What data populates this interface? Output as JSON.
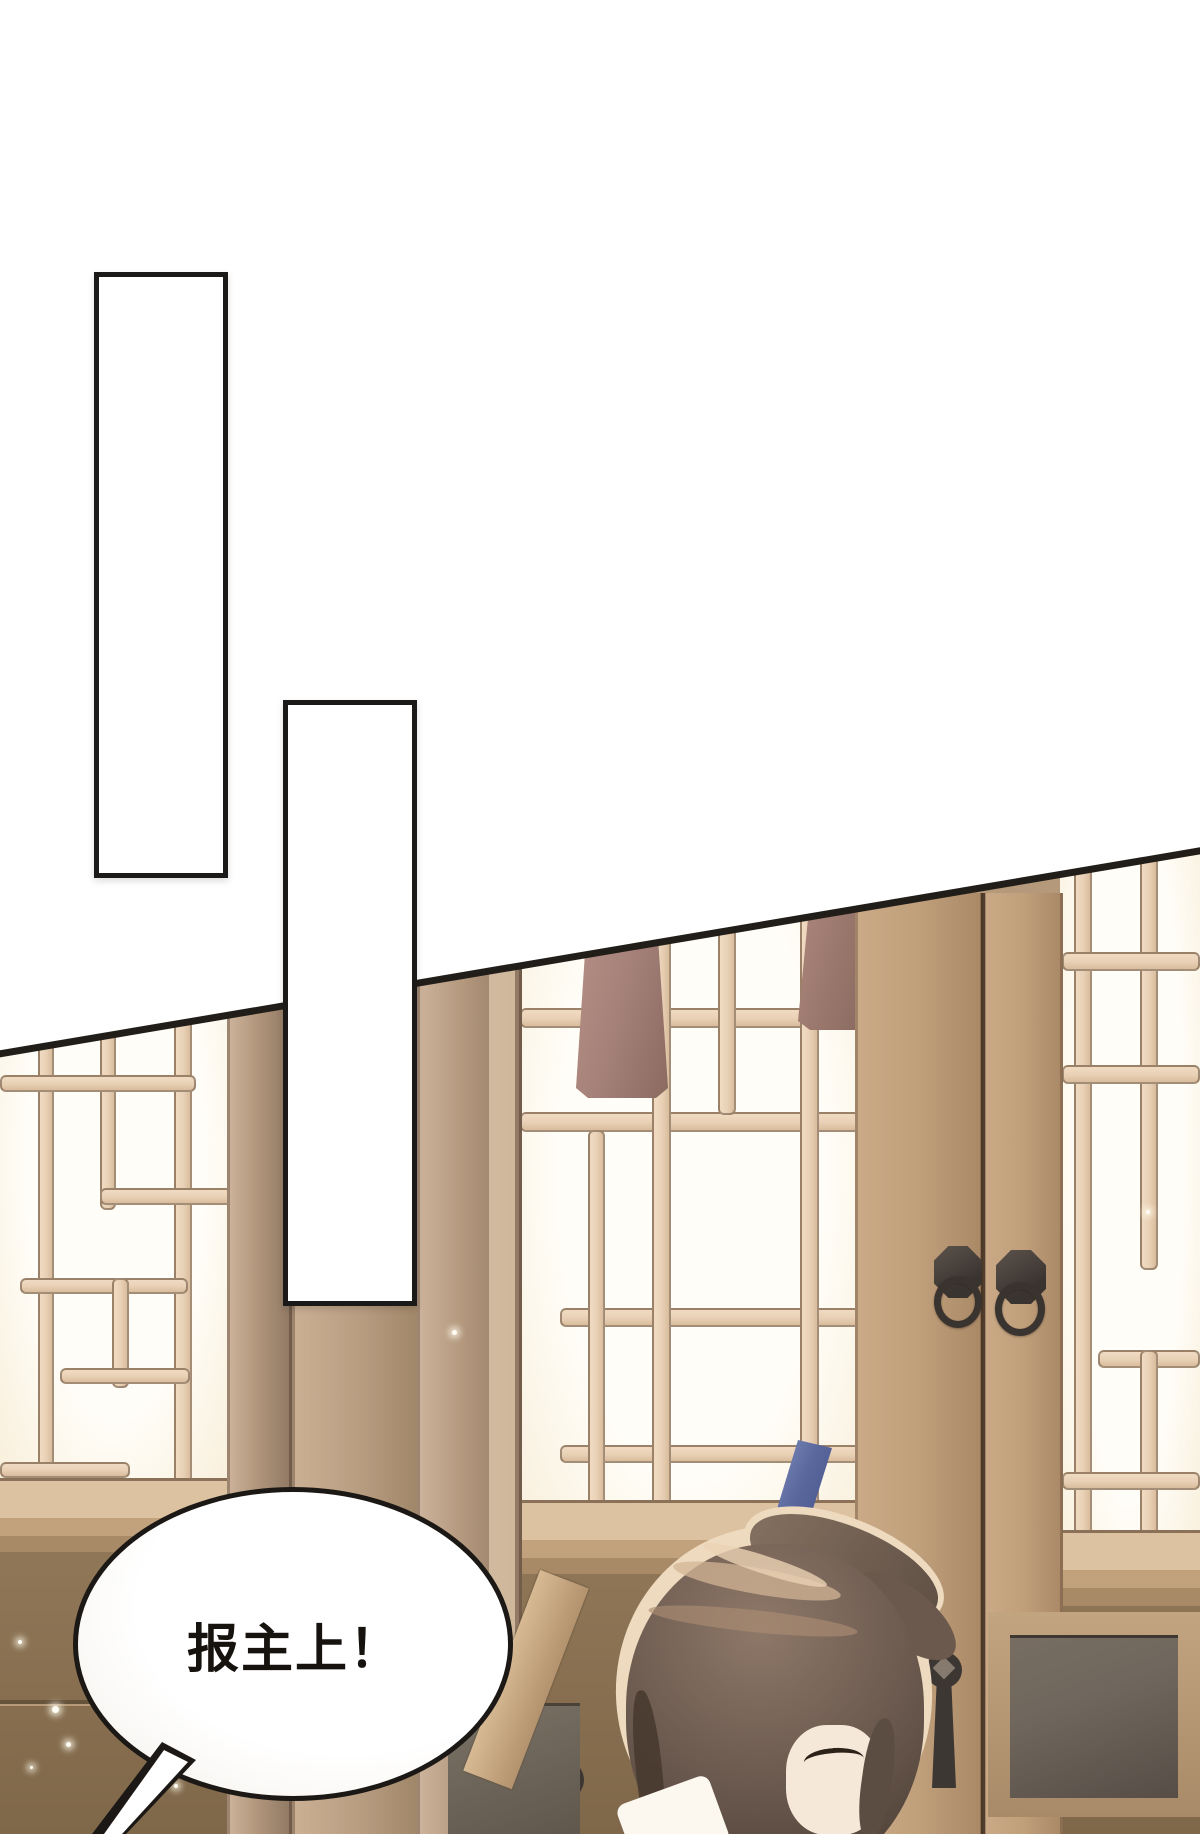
{
  "page": {
    "background_color": "#ffffff",
    "panel_border_color": "#1c1a18",
    "panel_count": 2
  },
  "speech_bubble": {
    "text": "报主上！",
    "fill_color": "#ffffff",
    "outline_color": "#1b1815",
    "text_color": "#16120e"
  },
  "scene": {
    "colors": {
      "wall_wood": "#97805f",
      "lattice_bar": "#e8d0b5",
      "window_paper": "#fffdf7",
      "pillar_wood": "#b2977c",
      "door_wood": "#c09f7b",
      "lamp_shade": "#a58179",
      "knocker_metal": "#46403c",
      "sill_wood": "#d8bd9c",
      "dark_panel": "#6f675d",
      "hair": "#6f5d52",
      "hair_highlight": "#c9ae93",
      "hair_rim": "#eedabf",
      "hairpin_blue": "#5a689e",
      "hairpin_red": "#7a2a21",
      "skin": "#f5e8d9"
    }
  }
}
